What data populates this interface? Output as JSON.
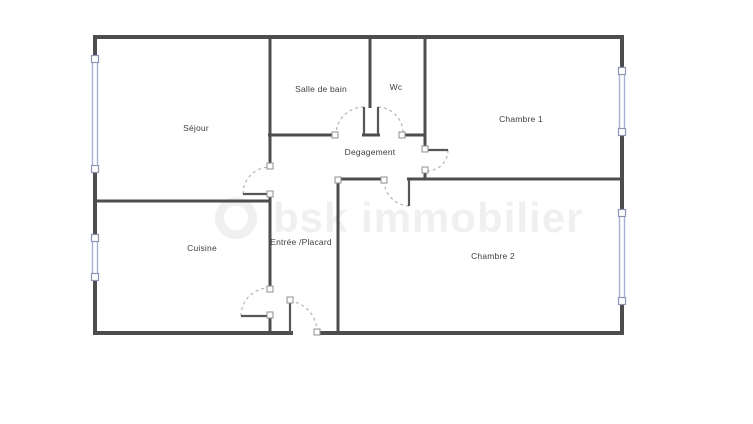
{
  "plan": {
    "colors": {
      "wall": "#4d4d4d",
      "door_leaf": "#565656",
      "arc": "#b4b4b4",
      "window": "#a9aed6",
      "window_handle_border": "#8f95b5",
      "node_border": "#8f8f8f",
      "label": "#3e3e3e",
      "watermark": "#f0f0f0",
      "background": "#ffffff"
    },
    "labels": [
      {
        "id": "sejour",
        "text": "Séjour",
        "x": 196,
        "y": 128
      },
      {
        "id": "salle-de-bain",
        "text": "Salle de bain",
        "x": 321,
        "y": 89
      },
      {
        "id": "wc",
        "text": "Wc",
        "x": 396,
        "y": 87
      },
      {
        "id": "chambre-1",
        "text": "Chambre 1",
        "x": 521,
        "y": 119
      },
      {
        "id": "degagement",
        "text": "Degagement",
        "x": 370,
        "y": 152
      },
      {
        "id": "cuisine",
        "text": "Cuisine",
        "x": 202,
        "y": 248
      },
      {
        "id": "entree-placard",
        "text": "Entrée /Placard",
        "x": 301,
        "y": 242
      },
      {
        "id": "chambre-2",
        "text": "Chambre 2",
        "x": 493,
        "y": 256
      }
    ],
    "watermark": {
      "text": "bsk immobilier"
    },
    "geometry": {
      "walls_exterior": [
        [
          93,
          37,
          624,
          37
        ],
        [
          95,
          35,
          95,
          59
        ],
        [
          95,
          169,
          95,
          238
        ],
        [
          95,
          277,
          95,
          335
        ],
        [
          622,
          35,
          622,
          71
        ],
        [
          622,
          132,
          622,
          213
        ],
        [
          622,
          301,
          622,
          335
        ],
        [
          93,
          333,
          293,
          333
        ],
        [
          317,
          333,
          624,
          333
        ]
      ],
      "walls_interior": [
        [
          270,
          37,
          270,
          165
        ],
        [
          270,
          196,
          270,
          288
        ],
        [
          270,
          315,
          270,
          334
        ],
        [
          95,
          201,
          271,
          201
        ],
        [
          268,
          135,
          334,
          135
        ],
        [
          362,
          135,
          380,
          135
        ],
        [
          402,
          135,
          426,
          135
        ],
        [
          370,
          37,
          370,
          108
        ],
        [
          425,
          37,
          425,
          148
        ],
        [
          425,
          170,
          425,
          180
        ],
        [
          337,
          179,
          384,
          179
        ],
        [
          407,
          179,
          623,
          179
        ],
        [
          338,
          178,
          338,
          334
        ]
      ],
      "door_leaves": [
        [
          243,
          194,
          270,
          194
        ],
        [
          241,
          316,
          270,
          316
        ],
        [
          364,
          107,
          364,
          134
        ],
        [
          378,
          107,
          378,
          134
        ],
        [
          427,
          150,
          448,
          150
        ],
        [
          409,
          180,
          409,
          206
        ],
        [
          290,
          301,
          290,
          333
        ]
      ],
      "door_arcs": [
        "M243,194 A27,27 0 0 1 270,167",
        "M241,316 A28,28 0 0 1 270,288",
        "M364,107 A28,28 0 0 0 336,134",
        "M378,107 A26,26 0 0 1 403,134",
        "M448,150 A21,21 0 0 1 428,171",
        "M409,206 A26,26 0 0 1 384,181",
        "M290,301 A31,31 0 0 1 317,331"
      ],
      "windows": [
        [
          92.5,
          59,
          5,
          110
        ],
        [
          92.5,
          238,
          5,
          39
        ],
        [
          619.5,
          71,
          5,
          61
        ],
        [
          619.5,
          213,
          5,
          88
        ]
      ],
      "window_handles": [
        [
          95,
          59
        ],
        [
          95,
          169
        ],
        [
          95,
          238
        ],
        [
          95,
          277
        ],
        [
          622,
          71
        ],
        [
          622,
          132
        ],
        [
          622,
          213
        ],
        [
          622,
          301
        ]
      ],
      "door_nodes": [
        [
          270,
          166
        ],
        [
          270,
          194
        ],
        [
          270,
          289
        ],
        [
          270,
          315
        ],
        [
          335,
          135
        ],
        [
          402,
          135
        ],
        [
          425,
          149
        ],
        [
          425,
          170
        ],
        [
          384,
          180
        ],
        [
          338,
          180
        ],
        [
          290,
          300
        ],
        [
          317,
          332
        ]
      ]
    }
  }
}
